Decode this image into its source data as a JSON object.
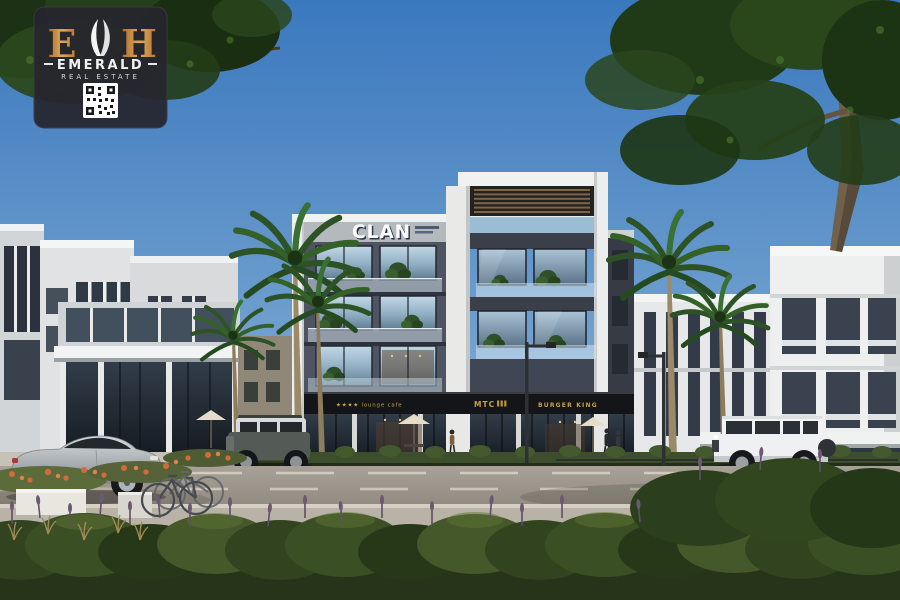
{
  "watermark_badge": {
    "monogram_left": "E",
    "monogram_right": "H",
    "brand_name": "EMERALD",
    "tagline": "REAL ESTATE",
    "qr_code": "qr-code",
    "accent_color": "#c98a3f",
    "background_color": "#26262e"
  },
  "building": {
    "main_sign": "CLAN",
    "storefront_signs": [
      {
        "label": "★★★★ lounge cafe",
        "text_color": "#c9a23f",
        "background": "#141518"
      },
      {
        "label": "MTC",
        "text_color": "#c9a23f",
        "background": "#141518"
      },
      {
        "label": "BURGER KING",
        "text_color": "#c9a23f",
        "background": "#141518"
      }
    ]
  },
  "scene": {
    "type": "architectural-exterior-render",
    "time_of_day": "day",
    "sky_top": "#3a78be",
    "sky_horizon": "#bdd4e7",
    "vehicles": [
      {
        "name": "silver sports car",
        "color": "#aeb3b8"
      },
      {
        "name": "dark SUV",
        "color": "#545a55"
      },
      {
        "name": "white G-Class SUV",
        "color": "#eef0f1"
      },
      {
        "name": "red bicycle",
        "color": "#b5423c"
      },
      {
        "name": "parked bicycles",
        "color": "#6a6f73"
      }
    ],
    "vegetation": [
      "palm trees",
      "street trees",
      "hedges",
      "lavender",
      "orange flowers"
    ]
  }
}
